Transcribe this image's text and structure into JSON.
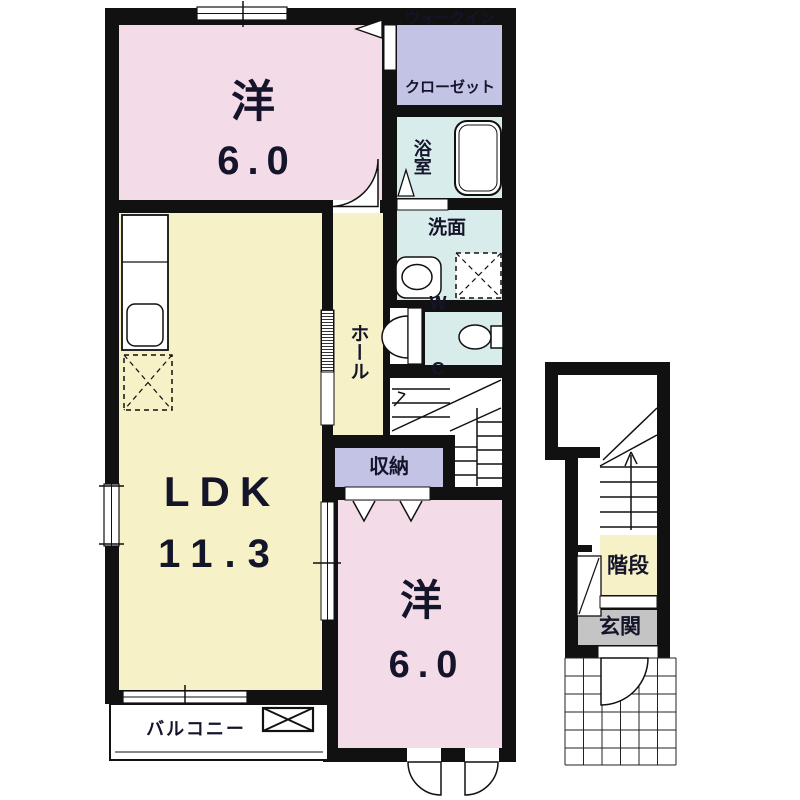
{
  "floor_plan": {
    "rooms": {
      "bedroom_top": {
        "name": "洋",
        "area": "6.0"
      },
      "walk_in_closet": {
        "line1": "ウォークイン",
        "line2": "クローゼット"
      },
      "bathroom": {
        "name": "浴室"
      },
      "washroom": {
        "name": "洗面"
      },
      "toilet": {
        "line1": "W",
        "line2": "C"
      },
      "hall": {
        "name": "ホール"
      },
      "storage": {
        "name": "収納"
      },
      "ldk": {
        "name": "LDK",
        "area": "11.3"
      },
      "bedroom_bottom": {
        "name": "洋",
        "area": "6.0"
      },
      "balcony": {
        "name": "バルコニー"
      },
      "stairwell": {
        "name": "階段"
      },
      "entrance": {
        "name": "玄関"
      }
    },
    "palette": {
      "wall": "#111111",
      "bedroom_pink": "#f3dbe7",
      "living_yellow": "#f6f1c6",
      "closet_lavender": "#c3c3e5",
      "wet_area_cyan": "#d8eceb",
      "entrance_gray": "#c4c4c4",
      "label_text": "#14142b"
    }
  }
}
